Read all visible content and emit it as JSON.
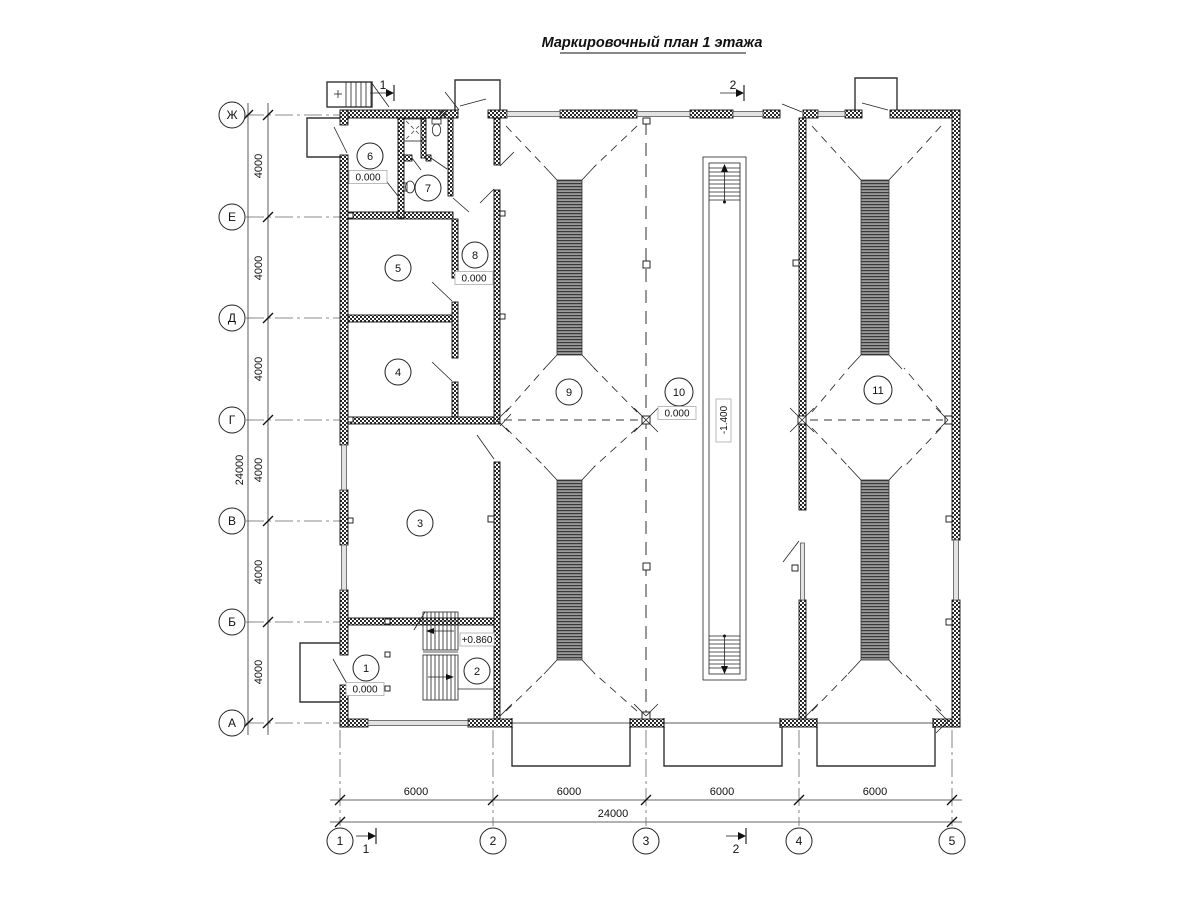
{
  "title": "Маркировочный план 1 этажа",
  "axes": {
    "rows": [
      {
        "label": "Ж"
      },
      {
        "label": "Е"
      },
      {
        "label": "Д"
      },
      {
        "label": "Г"
      },
      {
        "label": "В"
      },
      {
        "label": "Б"
      },
      {
        "label": "А"
      }
    ],
    "cols": [
      {
        "label": "1"
      },
      {
        "label": "2"
      },
      {
        "label": "3"
      },
      {
        "label": "4"
      },
      {
        "label": "5"
      }
    ]
  },
  "dimensions": {
    "row_spacing": [
      "4000",
      "4000",
      "4000",
      "4000",
      "4000",
      "4000"
    ],
    "row_total": "24000",
    "col_spacing": [
      "6000",
      "6000",
      "6000",
      "6000"
    ],
    "col_total": "24000"
  },
  "rooms": [
    {
      "num": "1",
      "elev": "0.000"
    },
    {
      "num": "2"
    },
    {
      "num": "3"
    },
    {
      "num": "4"
    },
    {
      "num": "5"
    },
    {
      "num": "6",
      "elev": "0.000"
    },
    {
      "num": "7"
    },
    {
      "num": "8",
      "elev": "0.000"
    },
    {
      "num": "9"
    },
    {
      "num": "10",
      "elev": "0.000"
    },
    {
      "num": "11"
    }
  ],
  "marks": {
    "stair_elev": "+0.860",
    "pit_elev": "-1.400",
    "section1": "1",
    "section2": "2"
  },
  "colors": {
    "ink": "#1a1a1a",
    "paper": "#ffffff"
  }
}
